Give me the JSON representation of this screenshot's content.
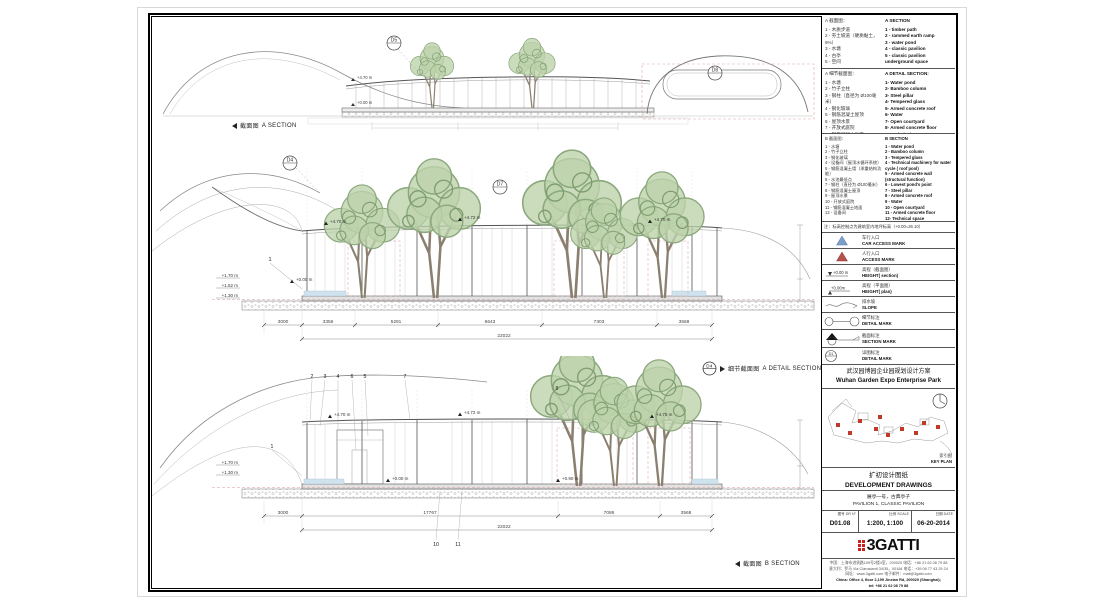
{
  "legend": {
    "a_section": {
      "title_cn": "A 截面图：",
      "title_en": "A SECTION",
      "cn": [
        "1 - 木质步道",
        "2 - 夯土坡道（硬质黏土，5%）",
        "3 - 水塘",
        "4 - 古亭",
        "5 - 空间"
      ],
      "en": [
        "1 - timber path",
        "2 - rammed earth ramp",
        "3 - water pond",
        "4 - classic pavilion",
        "5 - classic pavilion underground space"
      ]
    },
    "a_detail_section": {
      "title_cn": "A 细节截面图：",
      "title_en": "A DETAIL SECTION:",
      "cn": [
        "1 - 水塘",
        "2 - 竹子立柱",
        "3 - 钢柱（直径为 Ø100毫米）",
        "4 - 钢化玻璃",
        "5 - 钢筋混凝土屋顶",
        "6 - 屋顶水景",
        "7 - 开放式庭院",
        "8 - 钢筋混凝土地面",
        "9 - 设备间"
      ],
      "en": [
        "1- Water pond",
        "2- Bamboo column",
        "3- Steel pillar",
        "4- Tempered glass",
        "5- Armed concrete roof",
        "6- Water",
        "7- Open courtyard",
        "8- Armed concrete floor",
        "9- Technical space"
      ]
    },
    "b_section": {
      "title_cn": "B 截面图：",
      "title_en": "B SECTION",
      "cn": [
        "1 - 水塘",
        "2 - 竹子立柱",
        "3 - 钢化玻璃",
        "4 - 设备间（屋顶水循环系统）",
        "5 - 钢筋混凝土墙（承重结构功能）",
        "6 - 水池最低点",
        "7 - 钢柱（直径为 Ø100毫米）",
        "8 - 钢筋混凝土屋顶",
        "9 - 屋顶水景",
        "10 - 开放式庭院",
        "11 - 钢筋混凝土地面",
        "12 - 设备间"
      ],
      "en": [
        "1 - Water pond",
        "2 - Bamboo column",
        "3 - Tempered glass",
        "4 - Technical machinery for water cycle ( roof pool)",
        "5 - Armed concrete wall (structural function)",
        "6 - Lowest pond's point",
        "7 - Steel pillar",
        "8 - Armed concrete roof",
        "9 - Water",
        "10 - Open courtyard",
        "11 - Armed concrete floor",
        "12- Technical space"
      ]
    }
  },
  "marks": {
    "note": "注：标高控制点为建筑室内地坪标高（+0.00=26.10）",
    "height_symbol": "+0.00 m",
    "height_plan_symbol": "+0.00m",
    "detail_bubble": "D1",
    "rows": [
      {
        "cn": "车行入口",
        "en": "CAR ACCESS MARK"
      },
      {
        "cn": "人行入口",
        "en": "ACCESS MARK"
      },
      {
        "cn": "高程（截面图）",
        "en": "HEIGHT( section)"
      },
      {
        "cn": "高程（平面图）",
        "en": "HEIGHT( plan)"
      },
      {
        "cn": "排水坡",
        "en": "SLOPE"
      },
      {
        "cn": "细节标注",
        "en": "DETAIL MARK"
      },
      {
        "cn": "截面标注",
        "en": "SECTION MARK"
      },
      {
        "cn": "详图标注",
        "en": "DETAIL MARK"
      }
    ]
  },
  "project": {
    "title_cn": "武汉园博园企业园规划设计方案",
    "title_en": "Wuhan Garden Expo Enterprise Park"
  },
  "key_plan": {
    "label_cn": "索引图",
    "label_en": "KEY PLAN"
  },
  "titleblock": {
    "phase_cn": "扩初设计图纸",
    "phase_en": "DEVELOPMENT DRAWINGS",
    "sheet_cn": "展亭一号，古典亭子",
    "sheet_en": "PAVILION 1, CLASSIC PAVILION",
    "drn_label": "图号 DR N°",
    "scale_label": "比例 SCALE",
    "date_label": "日期 DATE",
    "drn": "D01.08",
    "scale": "1:200, 1:100",
    "date": "06-20-2014"
  },
  "logo": {
    "text": "3GATTI"
  },
  "address": {
    "cn1": "中国：上海市进贤路199号2楼4室，200020 电话：+86 21 62 08 79 88",
    "cn2": "意大利：罗马 Via Clarostanti 34/35，00184 电话：+39 06 77 43 29 24",
    "cn3": "网址：www.3gatti.com  电子邮件：mail@3gatti.com",
    "en1": "China: Office 4, floor 2,199 Jinxian Rd, 200020 (Shanghai);",
    "en2": "tel: +86 21 62 08 79 88",
    "en3": "Italy: Via Os. Clarostanti 34/35 84 Rome ; Tel: +39 06 77 43 29 24",
    "en4": "web: www.3gatti.com ; e-mail: mail@3gatti.com"
  },
  "drawings": {
    "a_section": {
      "label_cn": "截面图",
      "label_en": "A SECTION",
      "bubbles": [
        "D5",
        "D8"
      ],
      "elev": [
        "+4.70 m",
        "+0.00 m"
      ]
    },
    "a_detail": {
      "bubble": "D4",
      "label_cn": "细节截面图",
      "label_en": "A DETAIL SECTION",
      "bubbles": [
        "D4",
        "D7"
      ],
      "elev_top": [
        "+4.70 m",
        "+4.72 m",
        "+4.70 m"
      ],
      "elev_left": [
        "+1.70 m",
        "+1.52 m",
        "+1.30 m"
      ],
      "elev_zero": "+0.00 m",
      "callout": "1",
      "dims": [
        "3356",
        "5291",
        "6643",
        "7303",
        "3568"
      ],
      "dim_left": "3000",
      "dim_total": "22022"
    },
    "b_section": {
      "label_cn": "截面图",
      "label_en": "B SECTION",
      "elev_top": [
        "+4.70 m",
        "+4.72 m",
        "+4.70 m"
      ],
      "elev_left": [
        "+1.70 m",
        "+1.30 m"
      ],
      "elev_mid": [
        "+0.00 m",
        "+0.90 m"
      ],
      "callouts_top": [
        "2",
        "3",
        "4",
        "6",
        "5",
        "7",
        "9"
      ],
      "callout_left": "1",
      "callouts_bottom": [
        "10",
        "11"
      ],
      "dims": [
        "17767",
        "7086",
        "3568"
      ],
      "dim_left": "3000",
      "dim_total": "22022"
    }
  }
}
